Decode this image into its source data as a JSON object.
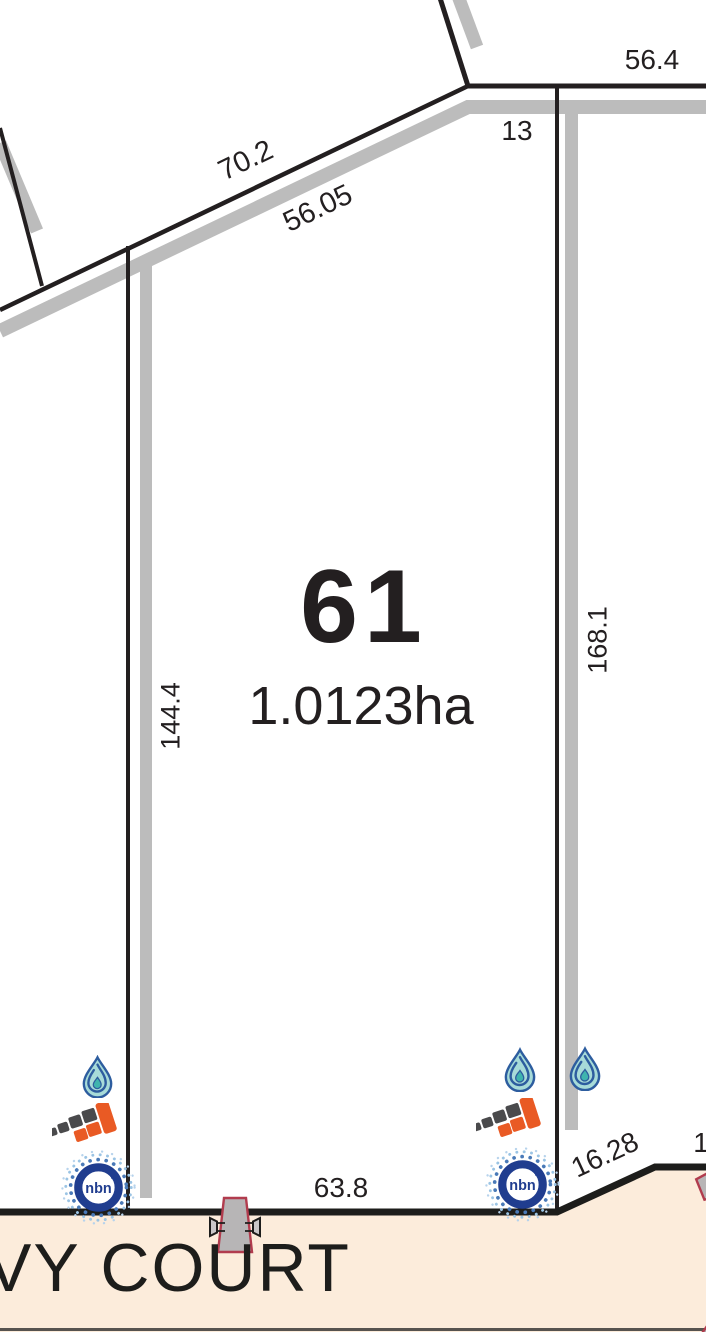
{
  "title": "Subdivision plan - Lot 61",
  "lot": {
    "number": "61",
    "area": "1.0123ha"
  },
  "street": {
    "name": "VY COURT"
  },
  "dimensions": {
    "boundary_nw": "70.2",
    "road_nw": "56.05",
    "boundary_top": "56.4",
    "offset_top": "13",
    "boundary_west": "144.4",
    "boundary_east": "168.1",
    "frontage_south": "63.8",
    "splay_se": "16.28",
    "partial_right": "1"
  },
  "icons": {
    "water_drop": "water-drop",
    "brick_tiles": "brick-tiles",
    "nbn_label": "nbn",
    "nbn_tm": "™",
    "power_pole": "power-pole"
  },
  "colors": {
    "line_black": "#231f20",
    "road_gray": "#bcbcbc",
    "road_fill": "#fcecdb",
    "bottom_edge": "#57534f",
    "brick_orange": "#e95a24",
    "brick_gray": "#4a4a4c",
    "nbn_navy": "#203d8f",
    "halo_blue": "#4a7ab8",
    "halo_light": "#9bc4e4",
    "drop_fill": "#a7dbd8",
    "drop_stroke": "#2d5d9f",
    "drop_center": "#3fb4ae",
    "pole_fill": "#b7b5b6",
    "pole_stroke": "#b13c4e"
  }
}
